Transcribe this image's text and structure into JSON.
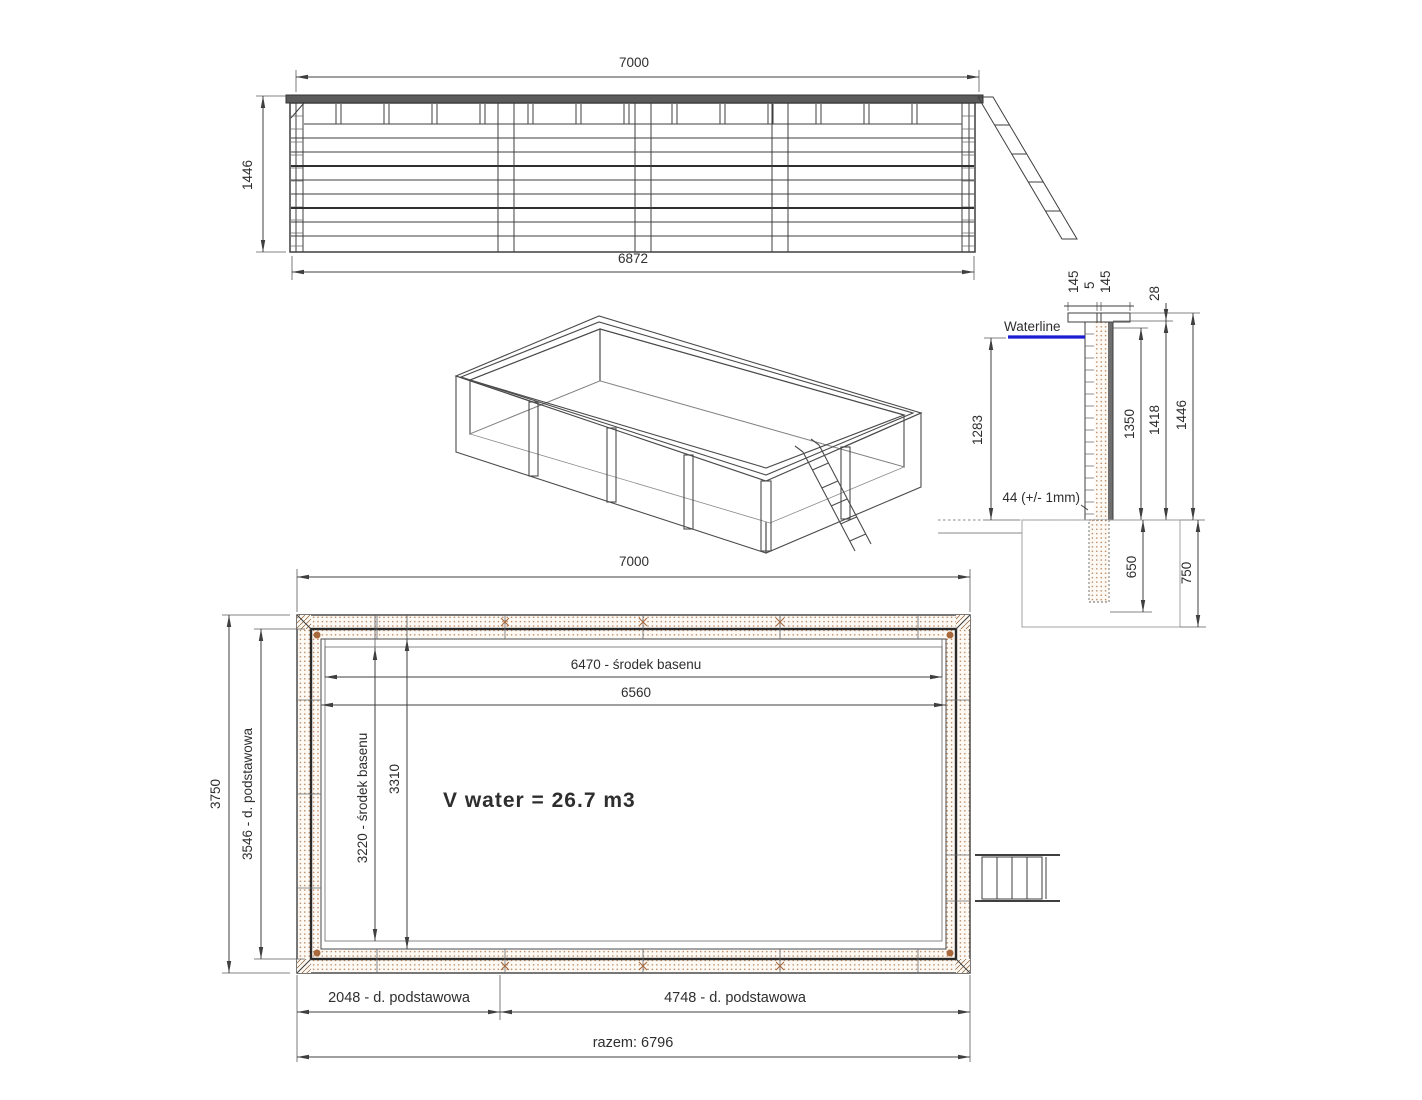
{
  "colors": {
    "line": "#3f3f3f",
    "wood": "#a8693c",
    "waterline_blue": "#1b1bd0",
    "dark_fill": "#6e6e6e",
    "pit_outline": "#999999"
  },
  "elevation": {
    "dim_top": "7000",
    "dim_height": "1446",
    "dim_bottom": "6872"
  },
  "section": {
    "cap_dim_left": "145",
    "cap_dim_center": "5",
    "cap_dim_right": "145",
    "waterline_label": "Waterline",
    "dim_waterline_to_ground": "1283",
    "wall_thickness_note": "44 (+/- 1mm)",
    "dim_cap_thickness": "28",
    "dim_plank_height": "1350",
    "dim_wall_height": "1418",
    "dim_total_height": "1446",
    "dim_post_below_ground": "650",
    "dim_pit_depth": "750"
  },
  "plan": {
    "dim_top": "7000",
    "dim_side_total": "3750",
    "dim_side_base": "3546 - d. podstawowa",
    "dim_inner_center_length": "6470 - środek basenu",
    "dim_inner_length": "6560",
    "dim_inner_center_width": "3220 - środek basenu",
    "dim_inner_width": "3310",
    "water_volume": "V water = 26.7 m3",
    "dim_base_left": "2048 - d. podstawowa",
    "dim_base_right": "4748 - d. podstawowa",
    "dim_base_total": "razem: 6796"
  }
}
